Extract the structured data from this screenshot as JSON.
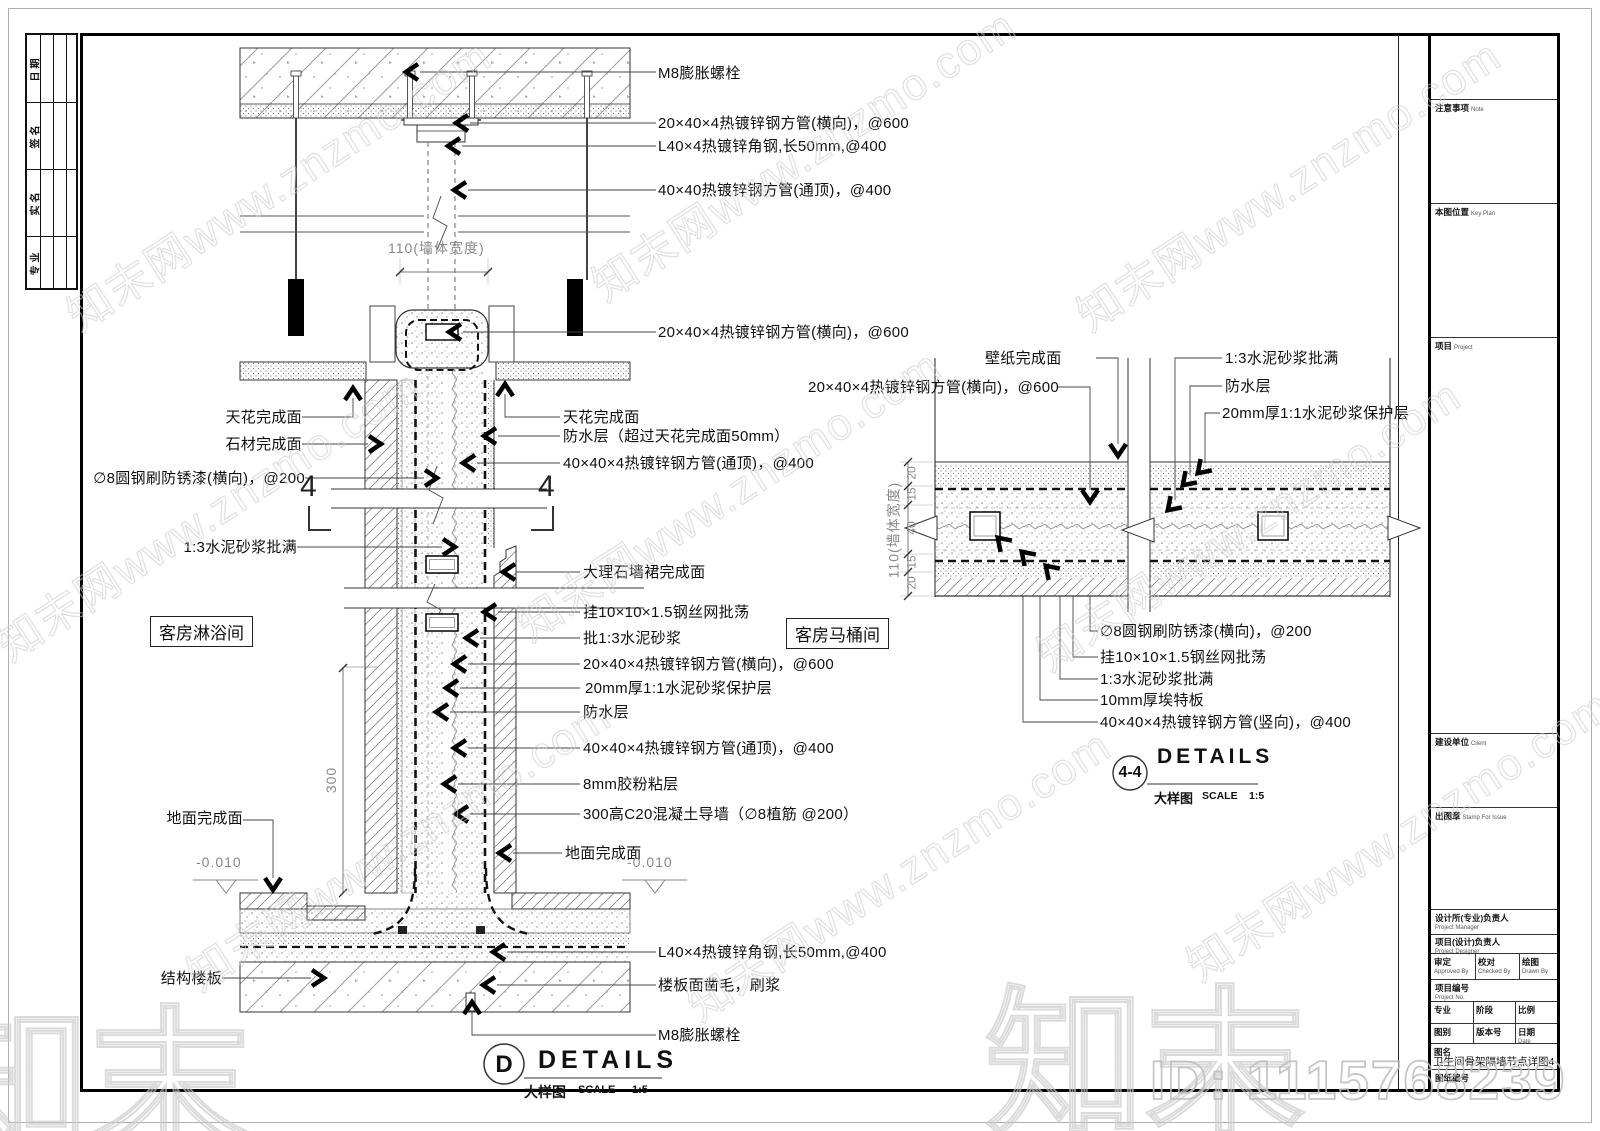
{
  "page": {
    "watermark_text": "知末网www.znzmo.com",
    "watermark_logo": "知末",
    "id_watermark": "ID: 1115768239"
  },
  "left_table": {
    "rows": [
      "日期",
      "签名",
      "实名",
      "专业"
    ]
  },
  "title_block": {
    "note": {
      "zh": "注意事项",
      "en": "Note"
    },
    "key_plan": {
      "zh": "本图位置",
      "en": "Key Plan"
    },
    "project": {
      "zh": "项目",
      "en": "Project"
    },
    "client": {
      "zh": "建设单位",
      "en": "Client"
    },
    "stamp": {
      "zh": "出图章",
      "en": "Stamp For Issue"
    },
    "project_manager": {
      "zh": "设计所(专业)负责人",
      "en": "Project Manager"
    },
    "project_designer": {
      "zh": "项目(设计)负责人",
      "en": "Project Designer"
    },
    "approved": {
      "zh": "审定",
      "en": "Approved By"
    },
    "checked": {
      "zh": "校对",
      "en": "Checked By"
    },
    "drawn": {
      "zh": "绘图",
      "en": "Drawn By"
    },
    "project_no": {
      "zh": "项目编号",
      "en": "Project No."
    },
    "specialty": {
      "zh": "专业"
    },
    "stage": {
      "zh": "阶段"
    },
    "scale": {
      "zh": "比例"
    },
    "category": {
      "zh": "图别"
    },
    "version": {
      "zh": "版本号"
    },
    "date": {
      "zh": "日期",
      "en": "Date"
    },
    "drawing_name_label": {
      "zh": "图名"
    },
    "drawing_name": "卫生间骨架隔墙节点详图4",
    "drawing_no": {
      "zh": "图纸编号"
    }
  },
  "detail_d": {
    "callouts_right": [
      "M8膨胀螺栓",
      "20×40×4热镀锌钢方管(横向)，@600",
      "L40×4热镀锌角钢,长50mm,@400",
      "40×40热镀锌钢方管(通顶)，@400",
      "20×40×4热镀锌钢方管(横向)，@600",
      "天花完成面",
      "防水层（超过天花完成面50mm）",
      "40×40×4热镀锌钢方管(通顶)，@400",
      "大理石墙裙完成面",
      "挂10×10×1.5钢丝网批荡",
      "批1:3水泥砂浆",
      "20×40×4热镀锌钢方管(横向)，@600",
      "20mm厚1:1水泥砂浆保护层",
      "防水层",
      "40×40×4热镀锌钢方管(通顶)，@400",
      "8mm胶粉粘层",
      "300高C20混凝土导墙（∅8植筋 @200）",
      "地面完成面",
      "L40×4热镀锌角钢,长50mm,@400",
      "楼板面凿毛，刷浆",
      "M8膨胀螺栓"
    ],
    "callouts_left": [
      "天花完成面",
      "石材完成面",
      "∅8圆钢刷防锈漆(横向)，@200",
      "1:3水泥砂浆批满",
      "地面完成面",
      "结构楼板"
    ],
    "room_left": "客房淋浴间",
    "room_right": "客房马桶间",
    "level_left": "-0.010",
    "level_right": "-0.010",
    "dim_width": "110(墙体宽度)",
    "dim_height": "300",
    "section_no": "4",
    "title": {
      "ref": "D",
      "name": "DETAILS",
      "sub": "大样图",
      "scale_label": "SCALE",
      "scale": "1:5"
    }
  },
  "detail_44": {
    "callouts_top": [
      "壁纸完成面",
      "20×40×4热镀锌钢方管(横向)，@600",
      "1:3水泥砂浆批满",
      "防水层",
      "20mm厚1:1水泥砂浆保护层"
    ],
    "callouts_bottom": [
      "∅8圆钢刷防锈漆(横向)，@200",
      "挂10×10×1.5钢丝网批荡",
      "1:3水泥砂浆批满",
      "10mm厚埃特板",
      "40×40×4热镀锌钢方管(竖向)，@400"
    ],
    "dim_width": "110(墙体宽度)",
    "dims": [
      "20",
      "15",
      "40",
      "15",
      "20"
    ],
    "title": {
      "ref": "4-4",
      "name": "DETAILS",
      "sub": "大样图",
      "scale_label": "SCALE",
      "scale": "1:5"
    }
  }
}
